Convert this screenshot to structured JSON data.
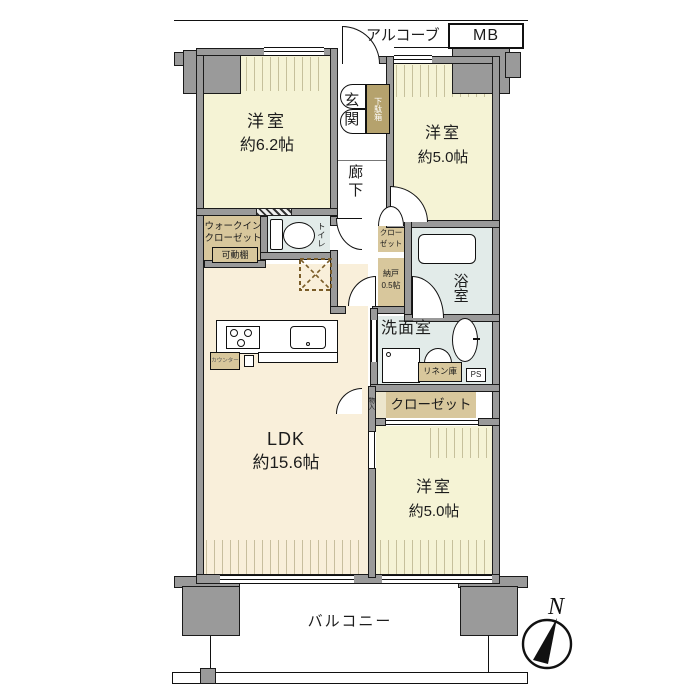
{
  "fp": {
    "alcove": "アルコーブ",
    "mb": "MB",
    "bedroom1": {
      "name": "洋室",
      "size": "約6.2帖"
    },
    "entrance": "玄関",
    "shoe_cabinet": "下駄箱",
    "hallway": "廊下",
    "bedroom2": {
      "name": "洋室",
      "size": "約5.0帖"
    },
    "wic": {
      "line1": "ウォークイン",
      "line2": "クローゼット",
      "shelf": "可動棚"
    },
    "toilet": "トイレ",
    "closet_mid": {
      "line1": "クロー",
      "line2": "ゼット"
    },
    "storeroom": {
      "name": "納戸",
      "size": "0.5帖"
    },
    "bathroom": "浴室",
    "washroom": "洗面室",
    "linen": "リネン庫",
    "ps": "PS",
    "storage_small": "物入",
    "closet2": "クローゼット",
    "ldk": {
      "name": "LDK",
      "size": "約15.6帖"
    },
    "bedroom3": {
      "name": "洋室",
      "size": "約5.0帖"
    },
    "kitchen_counter": "カウンター",
    "balcony": "バルコニー",
    "compass_north": "N",
    "colors": {
      "wall": "#9a9a9a",
      "outline": "#111111",
      "bedroom_fill": "#f5f3d5",
      "ldk_fill": "#f9efda",
      "closet_fill": "#d8c79c",
      "wet_fill": "#e2ebe9",
      "shoe_cabinet_fill": "#b5a26d"
    }
  }
}
